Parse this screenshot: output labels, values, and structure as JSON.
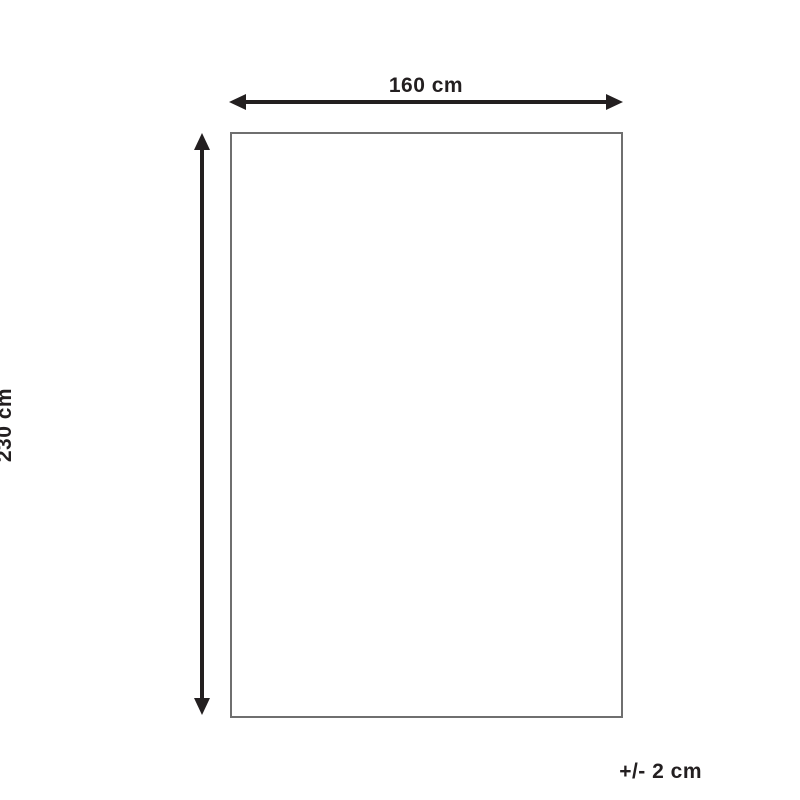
{
  "diagram": {
    "title": "product-dimension-diagram",
    "width_label": "160 cm",
    "height_label": "230 cm",
    "tolerance_label": "+/- 2 cm",
    "colors": {
      "arrow_and_text": "#231f20",
      "outline": "#6f6f6f",
      "background": "#ffffff"
    }
  }
}
